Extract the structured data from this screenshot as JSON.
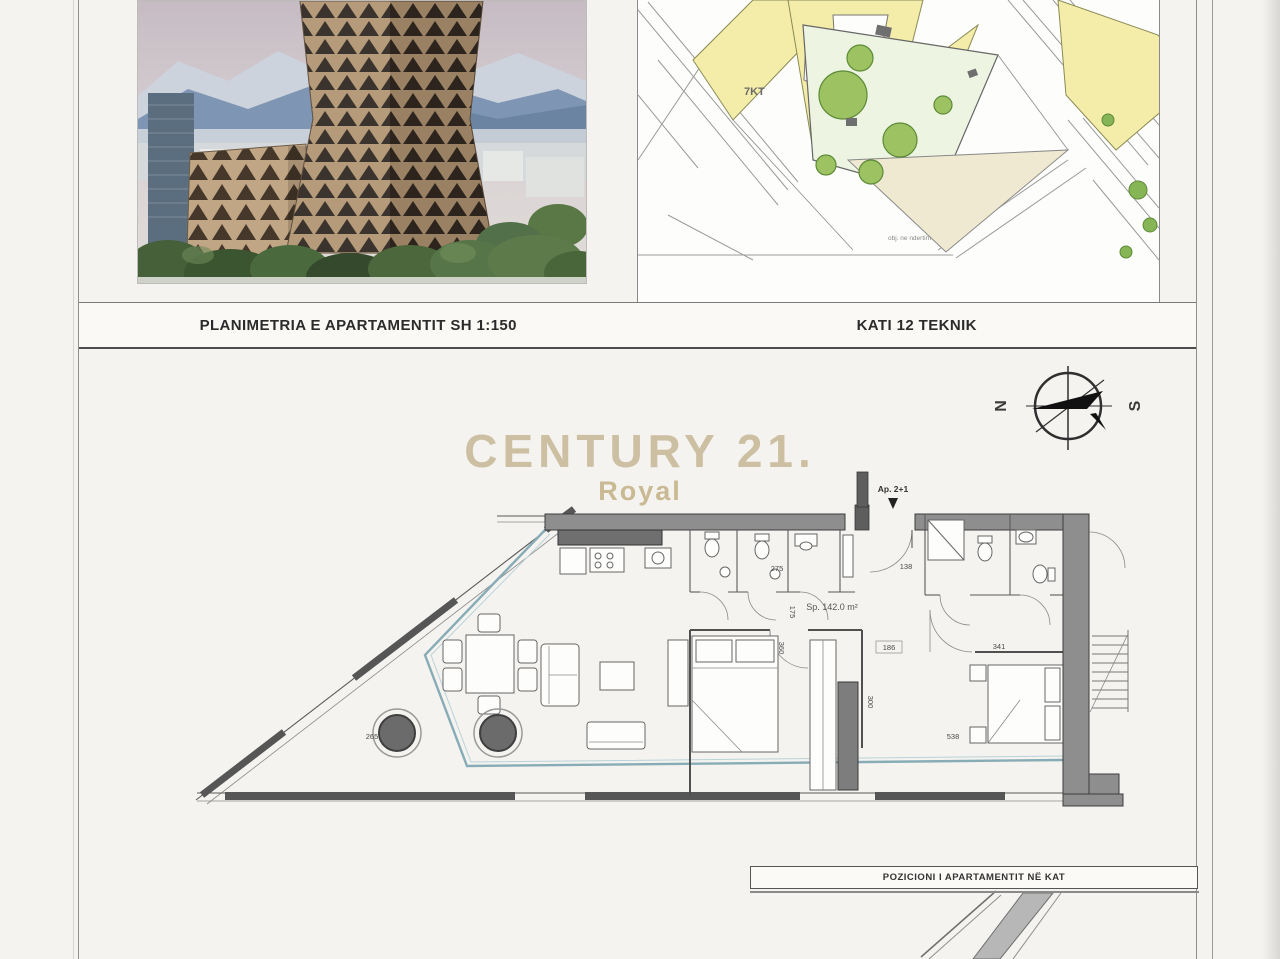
{
  "header": {
    "left_title": "PLANIMETRIA E APARTAMENTIT SH 1:150",
    "right_title": "KATI 12 TEKNIK"
  },
  "watermark": {
    "brand": "CENTURY 21.",
    "sub": "Royal"
  },
  "compass": {
    "north_label": "N",
    "south_label": "S"
  },
  "site_plan": {
    "zone_label": "7KT",
    "note_label": "obj. ne ndertim"
  },
  "floor_plan": {
    "apartment_label": "Ap. 2+1",
    "area_label": "Sp. 142.0 m²",
    "dimensions": [
      {
        "text": "265",
        "x": 372,
        "y": 739,
        "rot": 0
      },
      {
        "text": "275",
        "x": 777,
        "y": 571,
        "rot": 0
      },
      {
        "text": "138",
        "x": 906,
        "y": 569,
        "rot": 0
      },
      {
        "text": "360",
        "x": 779,
        "y": 648,
        "rot": 90
      },
      {
        "text": "175",
        "x": 790,
        "y": 612,
        "rot": 90
      },
      {
        "text": "186",
        "x": 889,
        "y": 650,
        "rot": 0
      },
      {
        "text": "341",
        "x": 999,
        "y": 649,
        "rot": 0
      },
      {
        "text": "300",
        "x": 868,
        "y": 702,
        "rot": 90
      },
      {
        "text": "538",
        "x": 953,
        "y": 739,
        "rot": 0
      }
    ]
  },
  "footer": {
    "position_label": "POZICIONI I APARTAMENTIT NË KAT"
  },
  "colors": {
    "watermark": "#cdbfa1",
    "parcel_yellow": "#f3eda9",
    "tree_green": "#9cc261",
    "glass_teal": "#87acb6",
    "wall_gray": "#8e8e8e"
  }
}
